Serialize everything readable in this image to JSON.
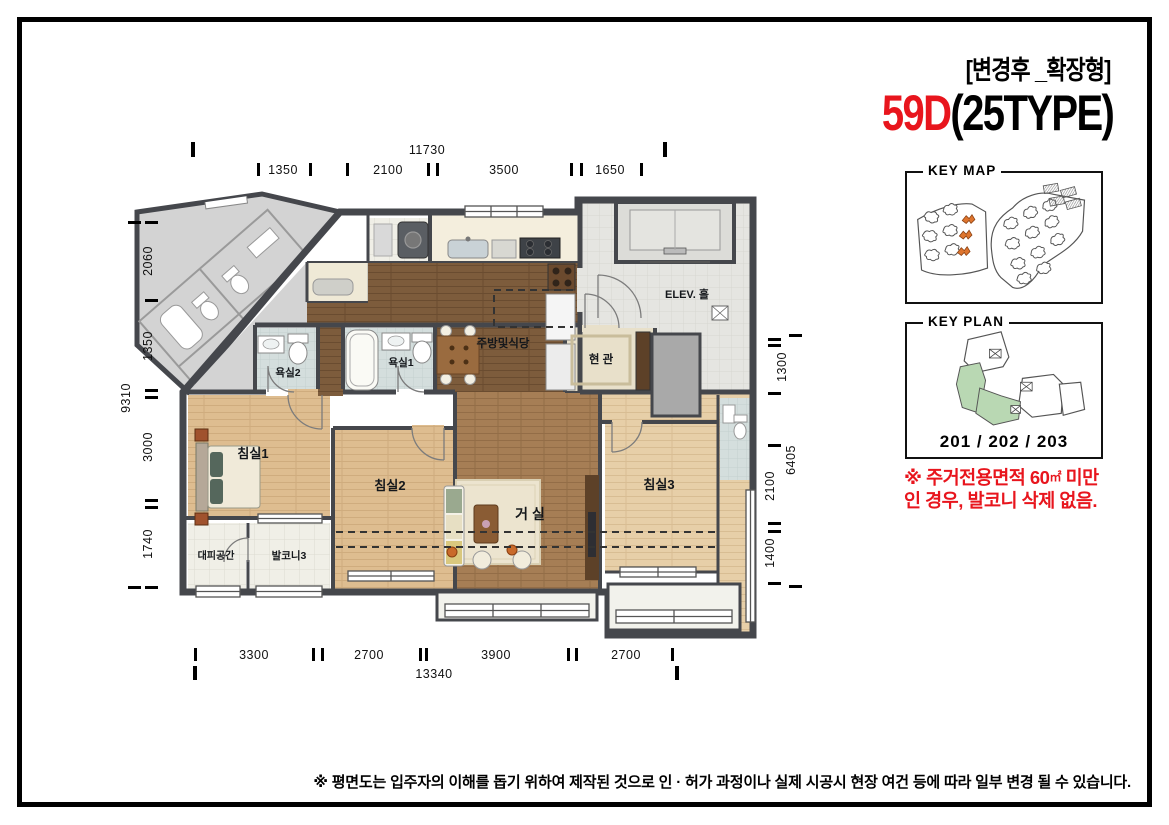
{
  "header": {
    "tag": "[변경후 _확장형]",
    "model": "59D",
    "type": "(25TYPE)"
  },
  "key_map": {
    "title": "KEY MAP",
    "highlight_color": "#de752e"
  },
  "key_plan": {
    "title": "KEY PLAN",
    "units": "201 / 202 / 203",
    "highlight_color": "#b9d8b3"
  },
  "notice": {
    "l1a": "※ 주거전용면적 60",
    "l1b": "㎡",
    "l1c": " 미만",
    "line2": "인 경우, 발코니 삭제 없음."
  },
  "rooms": {
    "bedroom1": "침실1",
    "bedroom2": "침실2",
    "bedroom3": "침실3",
    "living": "거 실",
    "kitchen": "주방및식당",
    "entrance": "현 관",
    "bath1": "욕실1",
    "bath2": "욕실2",
    "shelter": "대피공간",
    "balcony3": "발코니3",
    "elev_hall": "ELEV. 홀"
  },
  "dims": {
    "top_total": "11730",
    "top": [
      "1350",
      "2100",
      "3500",
      "1650"
    ],
    "bottom_total": "13340",
    "bottom": [
      "3300",
      "2700",
      "3900",
      "2700"
    ],
    "left_total": "9310",
    "left": [
      "2060",
      "1350",
      "3000",
      "1740"
    ],
    "right_total": "6405",
    "right": [
      "1300",
      "2100",
      "1400"
    ]
  },
  "disclaimer": "※ 평면도는 입주자의 이해를 돕기 위하여 제작된 것으로 인 · 허가 과정이나 실제 시공시 현장 여건 등에 따라 일부 변경 될 수 있습니다.",
  "colors": {
    "accent_red": "#e8151d",
    "wall": "#45474c",
    "keymap_orange": "#de752e",
    "keyplan_green": "#b9d8b3"
  }
}
